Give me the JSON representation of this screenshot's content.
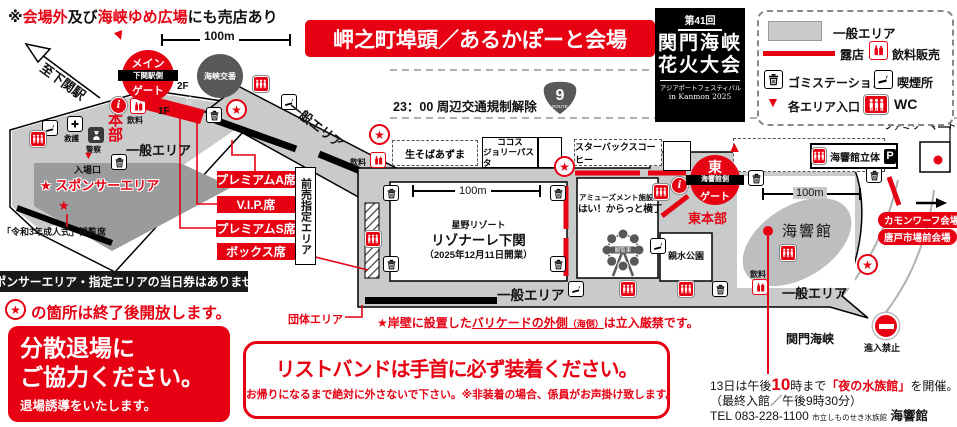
{
  "colors": {
    "red": "#e60012",
    "map_gray": "#c9caca",
    "sponsor_gray": "#9a9b9c",
    "dark": "#595757"
  },
  "header": {
    "note": {
      "prefix": "※",
      "red1": "会場外",
      "mid": "及び",
      "red2": "海峡ゆめ広場",
      "suffix": "にも売店あり"
    },
    "title": "岬之町埠頭／あるかぽーと会場"
  },
  "logo": {
    "top": "第41回",
    "main1": "関門海峡",
    "main2": "花火大会",
    "sub1": "アジアポートフェスティバル",
    "sub2": "in Kanmon 2025"
  },
  "legend": {
    "general": "一般エリア",
    "stall": "露店",
    "drink": "飲料販売",
    "trash": "ゴミステーション",
    "smoking": "喫煙所",
    "entrance": "各エリア入口",
    "wc": "WC"
  },
  "scale": {
    "label": "100m"
  },
  "map": {
    "to_station": "至下関駅",
    "main_gate": {
      "l1": "メイン",
      "l2": "下関駅側",
      "l3": "ゲート"
    },
    "police_box": "海峡交番",
    "f2": "2F",
    "f1": "1F",
    "rescue": "救護",
    "police": "警察",
    "hq": "本部",
    "drink": "飲料",
    "general": "一般エリア",
    "entrance": "入場口",
    "sponsor": "★ スポンサーエリア",
    "reiwa": "「令和3年成人式」観覧席",
    "seats": {
      "a": "プレミアムA席",
      "vip": "V.I.P.席",
      "s": "プレミアムS席",
      "box": "ボックス席"
    },
    "advance": "前売指定エリア",
    "traffic": "23：00 周辺交通規制解除",
    "route_num": "9",
    "route_word": "ROUTE",
    "shops": {
      "soba": "生そばあずま",
      "cocos": "ココス",
      "jolly": "ジョリーパスタ",
      "sbux": "スターバックスコーヒー"
    },
    "resort": {
      "l1": "星野リゾート",
      "l2": "リゾナーレ下関",
      "l3": "（2025年12月11日開業）"
    },
    "amusement": {
      "l1": "アミューズメント施設",
      "l2": "はい！からっと横丁",
      "ferris": "観覧車"
    },
    "east_gate": {
      "l1": "東",
      "l2": "海響館側",
      "l3": "ゲート"
    },
    "east_hq": "東本部",
    "parking": {
      "name": "海響館立体",
      "p": "P"
    },
    "familymart": "ファミリーマート",
    "aquarium": "海響館",
    "park": "親水公園",
    "kamon": "カモンワーフ会場",
    "karato": "唐戸市場前会場",
    "strait": "関門海峡",
    "no_entry": "進入禁止",
    "group": "団体エリア",
    "barricade": {
      "pre": "★岸壁に設置した",
      "u": "バリケードの外側",
      "small": "（海側）",
      "suf": "は立入厳禁です。"
    }
  },
  "notices": {
    "no_sameday": "スポンサーエリア・指定エリアの当日券はありません",
    "star_note": "の箇所は終了後開放します。",
    "dispersal": {
      "l1": "分散退場に",
      "l2": "ご協力ください。",
      "sub": "退場誘導をいたします。"
    },
    "wristband": {
      "main": "リストバンドは手首に必ず装着ください。",
      "sub": "お帰りになるまで絶対に外さないで下さい。※非装着の場合、係員がお声掛け致します。"
    },
    "aquarium_info": {
      "pre": "13日は午後",
      "big": "10",
      "mid": "時まで",
      "event": "「夜の水族館」",
      "suf": "を開催。",
      "l2": "（最終入館／午後9時30分）",
      "tel": "TEL 083-228-1100",
      "org": "市立しものせき水族館",
      "name": "海響館"
    }
  }
}
